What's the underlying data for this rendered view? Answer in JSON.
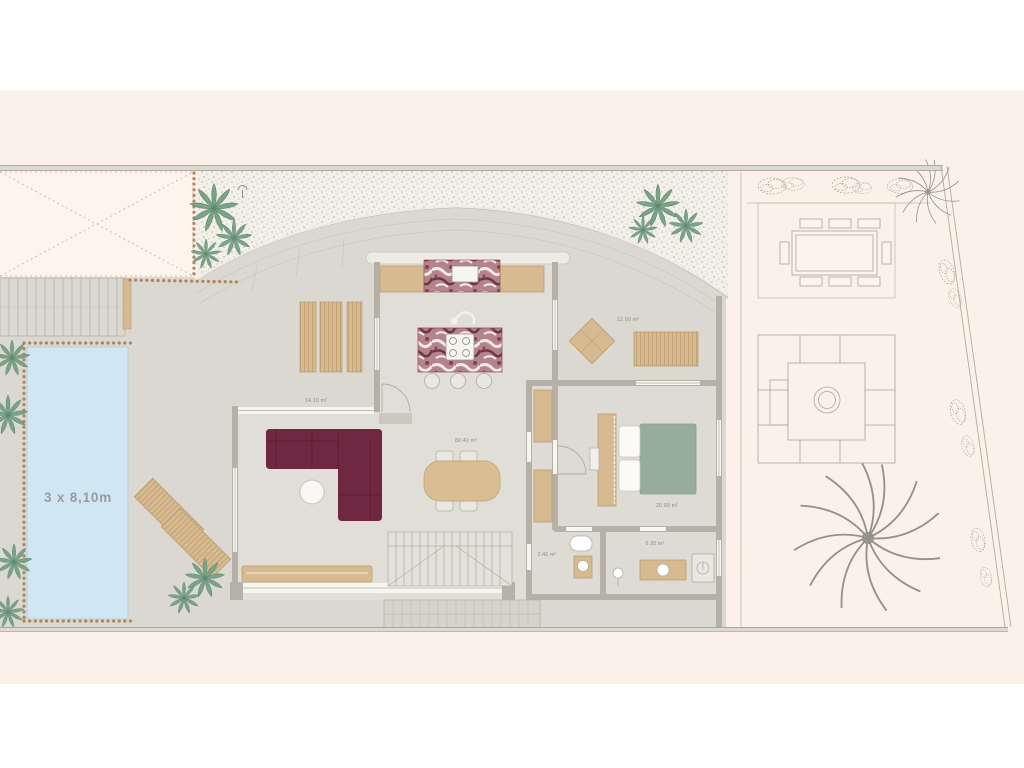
{
  "plan": {
    "pool": {
      "dimensions_label": "3 x 8,10m",
      "color": "#d0e7f3"
    },
    "rooms": {
      "covered_terrace": {
        "area_label": "14.10 m²"
      },
      "living_kitchen": {
        "area_label": "80.40 m²"
      },
      "outdoor_lounge_terrace": {
        "area_label": "12.90 m²"
      },
      "bedroom": {
        "area_label": "20.00 m²"
      },
      "bathroom": {
        "area_label": "2.40 m²"
      },
      "ensuite_bathroom": {
        "area_label": "6.30 m²"
      }
    },
    "colors": {
      "page": "#ffffff",
      "background_band": "#fbf1e8",
      "driveway": "#fdf4ec",
      "terrace": "#dbd8d1",
      "interior_floor": "#e0ded7",
      "gravel_base": "#f3f0e9",
      "wall": "#b6b1a6",
      "wood": "#d7ba90",
      "sofa": "#702741",
      "bed_duvet": "#95ad99",
      "marble": "#a2626c",
      "plant_green": "#7aa387",
      "bead_border": "#a87e52"
    }
  }
}
